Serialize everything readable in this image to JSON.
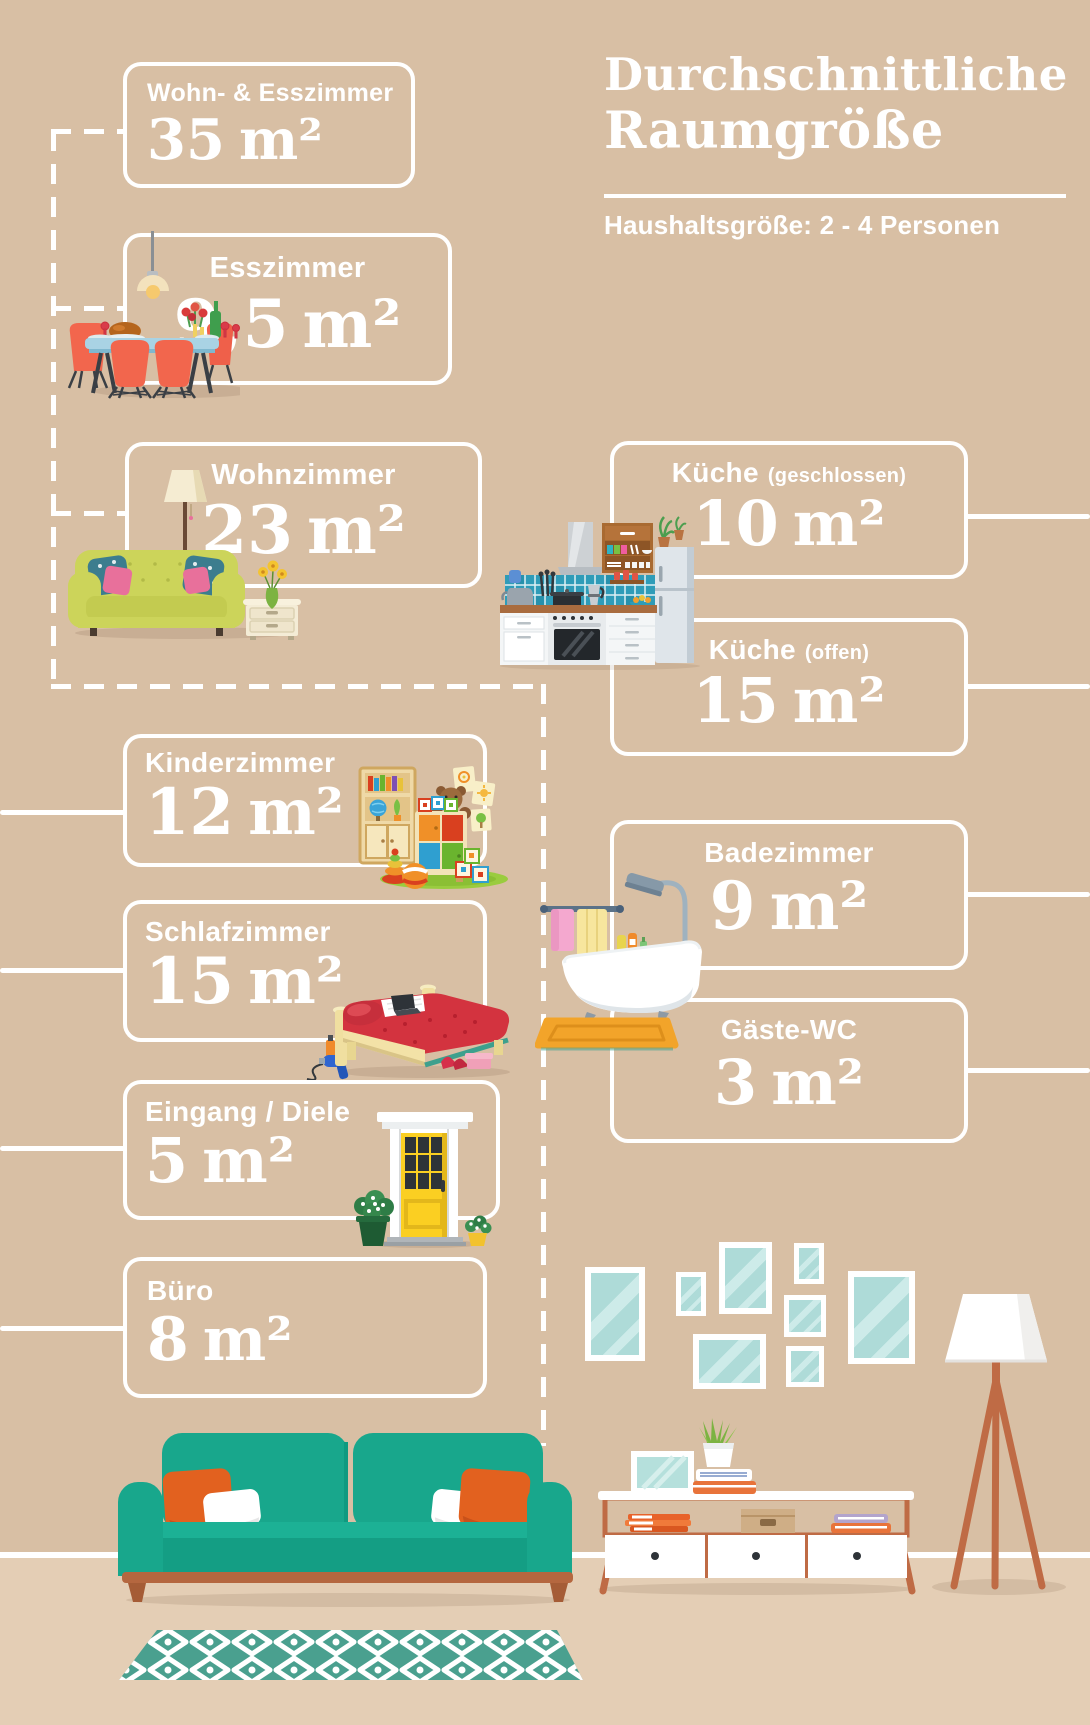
{
  "header": {
    "title_line1": "Durchschnittliche",
    "title_line2": "Raumgröße",
    "subtitle": "Haushaltsgröße: 2 - 4 Personen"
  },
  "rooms": [
    {
      "id": "wohn-esszimmer",
      "label": "Wohn- & Esszimmer",
      "value": "35",
      "unit": "m²"
    },
    {
      "id": "esszimmer",
      "label": "Esszimmer",
      "value": "9,5",
      "unit": "m²"
    },
    {
      "id": "wohnzimmer",
      "label": "Wohnzimmer",
      "value": "23",
      "unit": "m²"
    },
    {
      "id": "kueche-geschlossen",
      "label": "Küche",
      "label_note": "(geschlossen)",
      "value": "10",
      "unit": "m²"
    },
    {
      "id": "kueche-offen",
      "label": "Küche",
      "label_note": "(offen)",
      "value": "15",
      "unit": "m²"
    },
    {
      "id": "kinderzimmer",
      "label": "Kinderzimmer",
      "value": "12",
      "unit": "m²"
    },
    {
      "id": "schlafzimmer",
      "label": "Schlafzimmer",
      "value": "15",
      "unit": "m²"
    },
    {
      "id": "badezimmer",
      "label": "Badezimmer",
      "value": "9",
      "unit": "m²"
    },
    {
      "id": "gaeste-wc",
      "label": "Gäste-WC",
      "value": "3",
      "unit": "m²"
    },
    {
      "id": "eingang-diele",
      "label": "Eingang / Diele",
      "value": "5",
      "unit": "m²"
    },
    {
      "id": "buero",
      "label": "Büro",
      "value": "8",
      "unit": "m²"
    }
  ],
  "colors": {
    "background": "#d8bfa4",
    "floor": "#e4ceb5",
    "text": "#ffffff",
    "sofa_teal": "#18a78c",
    "accent_orange": "#e2611f",
    "wood_copper": "#bf6b45",
    "rug_teal": "#4aa08f",
    "frame_glass": "#b5e0dc",
    "kitchen_tile": "#2f9cb8",
    "door_yellow": "#fbcf22",
    "bed_red": "#d3333f"
  },
  "illustrations": [
    "pendant-lamp",
    "dining-table-set",
    "living-sofa-group",
    "kitchen-unit",
    "kids-room",
    "bed",
    "bathroom-tub",
    "entrance-door",
    "gallery-frames",
    "teal-sofa",
    "patterned-rug",
    "tv-console",
    "tripod-floor-lamp"
  ]
}
